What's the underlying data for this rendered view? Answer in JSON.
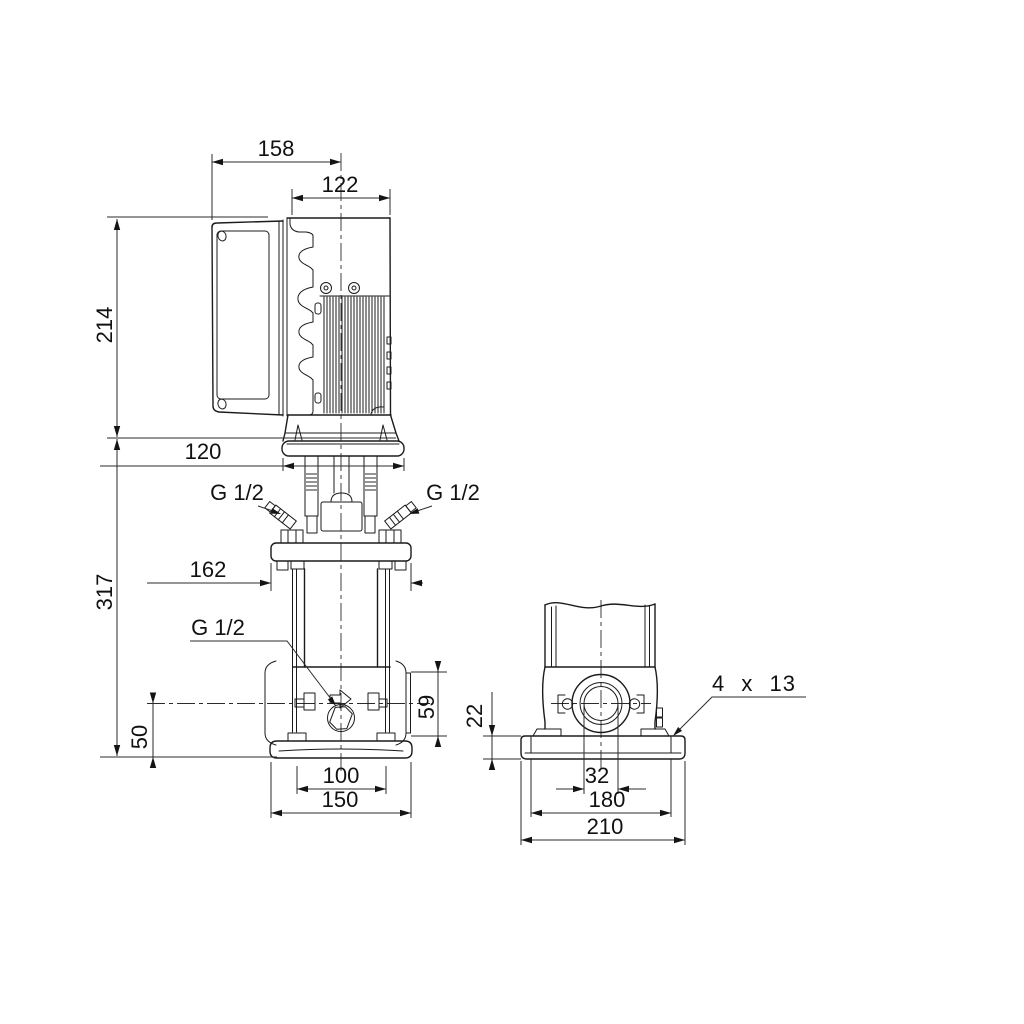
{
  "drawing": {
    "type": "pump-dimensional-drawing",
    "views": [
      "front-elevation",
      "side-elevation"
    ],
    "units": "mm",
    "line_color": "#1b1b1b",
    "background": "#ffffff",
    "labels": {
      "dim_158": "158",
      "dim_122": "122",
      "dim_214": "214",
      "dim_120": "120",
      "g_half_left": "G 1/2",
      "g_half_right": "G 1/2",
      "dim_162": "162",
      "g_half_drain": "G 1/2",
      "dim_317": "317",
      "dim_50": "50",
      "dim_59": "59",
      "dim_100": "100",
      "dim_150": "150",
      "dim_22": "22",
      "dim_4x13": "4 x 13",
      "dim_32": "32",
      "dim_180": "180",
      "dim_210": "210"
    }
  }
}
